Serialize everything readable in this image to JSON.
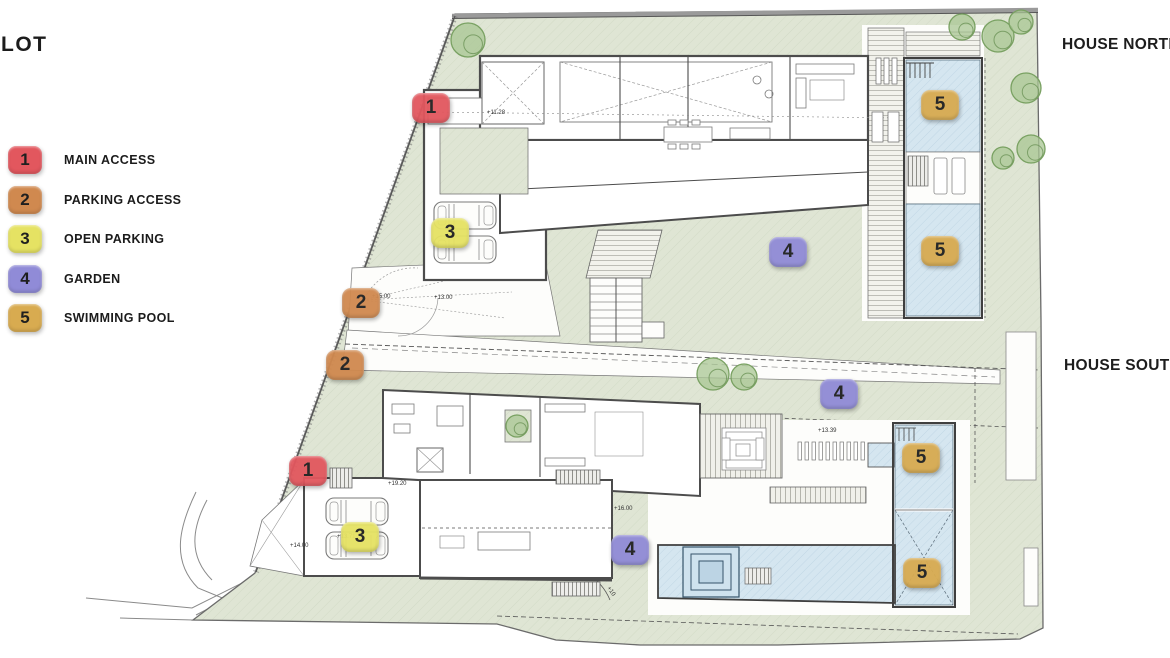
{
  "title": "LOT",
  "site_labels": {
    "north": "HOUSE NORTH",
    "south": "HOUSE SOUTH"
  },
  "legend": {
    "items": [
      {
        "num": "1",
        "label": "MAIN ACCESS",
        "color": "#e2575e"
      },
      {
        "num": "2",
        "label": "PARKING ACCESS",
        "color": "#d0894f"
      },
      {
        "num": "3",
        "label": "OPEN PARKING",
        "color": "#e5e263"
      },
      {
        "num": "4",
        "label": "GARDEN",
        "color": "#908bd7"
      },
      {
        "num": "5",
        "label": "SWIMMING POOL",
        "color": "#d8ab50"
      }
    ]
  },
  "plan": {
    "colors": {
      "grass": "#dfe5d4",
      "pool": "#d5e6f0",
      "wall": "#4c4c4c",
      "tree": "#a8c693"
    },
    "markers": [
      {
        "num": "1",
        "type": "main-access",
        "x": 431,
        "y": 108
      },
      {
        "num": "1",
        "type": "main-access",
        "x": 308,
        "y": 471
      },
      {
        "num": "2",
        "type": "parking-access",
        "x": 361,
        "y": 303
      },
      {
        "num": "2",
        "type": "parking-access",
        "x": 345,
        "y": 365
      },
      {
        "num": "3",
        "type": "open-parking",
        "x": 450,
        "y": 233
      },
      {
        "num": "3",
        "type": "open-parking",
        "x": 360,
        "y": 537
      },
      {
        "num": "4",
        "type": "garden",
        "x": 788,
        "y": 252
      },
      {
        "num": "4",
        "type": "garden",
        "x": 839,
        "y": 394
      },
      {
        "num": "4",
        "type": "garden",
        "x": 630,
        "y": 550
      },
      {
        "num": "5",
        "type": "swimming-pool",
        "x": 940,
        "y": 105
      },
      {
        "num": "5",
        "type": "swimming-pool",
        "x": 940,
        "y": 251
      },
      {
        "num": "5",
        "type": "swimming-pool",
        "x": 921,
        "y": 458
      },
      {
        "num": "5",
        "type": "swimming-pool",
        "x": 922,
        "y": 573
      }
    ],
    "annotations": [
      {
        "text": "+11.28",
        "x": 487,
        "y": 114,
        "rotate": 0
      },
      {
        "text": "+15.00",
        "x": 372,
        "y": 298,
        "rotate": 0
      },
      {
        "text": "+13.00",
        "x": 434,
        "y": 299,
        "rotate": 0
      },
      {
        "text": "+19.20",
        "x": 388,
        "y": 485,
        "rotate": 0
      },
      {
        "text": "+16.00",
        "x": 614,
        "y": 510,
        "rotate": 0
      },
      {
        "text": "+13.39",
        "x": 818,
        "y": 432,
        "rotate": 0
      },
      {
        "text": "+13.71",
        "x": 337,
        "y": 538,
        "rotate": 0
      },
      {
        "text": "+14.00",
        "x": 290,
        "y": 547,
        "rotate": 0
      },
      {
        "text": "+10",
        "x": 607,
        "y": 588,
        "rotate": 55
      }
    ],
    "trees": [
      {
        "x": 468,
        "y": 40,
        "r": 17
      },
      {
        "x": 962,
        "y": 27,
        "r": 13
      },
      {
        "x": 998,
        "y": 36,
        "r": 16
      },
      {
        "x": 1021,
        "y": 22,
        "r": 12
      },
      {
        "x": 1026,
        "y": 88,
        "r": 15
      },
      {
        "x": 1031,
        "y": 149,
        "r": 14
      },
      {
        "x": 1003,
        "y": 158,
        "r": 11
      },
      {
        "x": 713,
        "y": 374,
        "r": 16
      },
      {
        "x": 744,
        "y": 377,
        "r": 13
      },
      {
        "x": 517,
        "y": 426,
        "r": 11
      }
    ]
  }
}
